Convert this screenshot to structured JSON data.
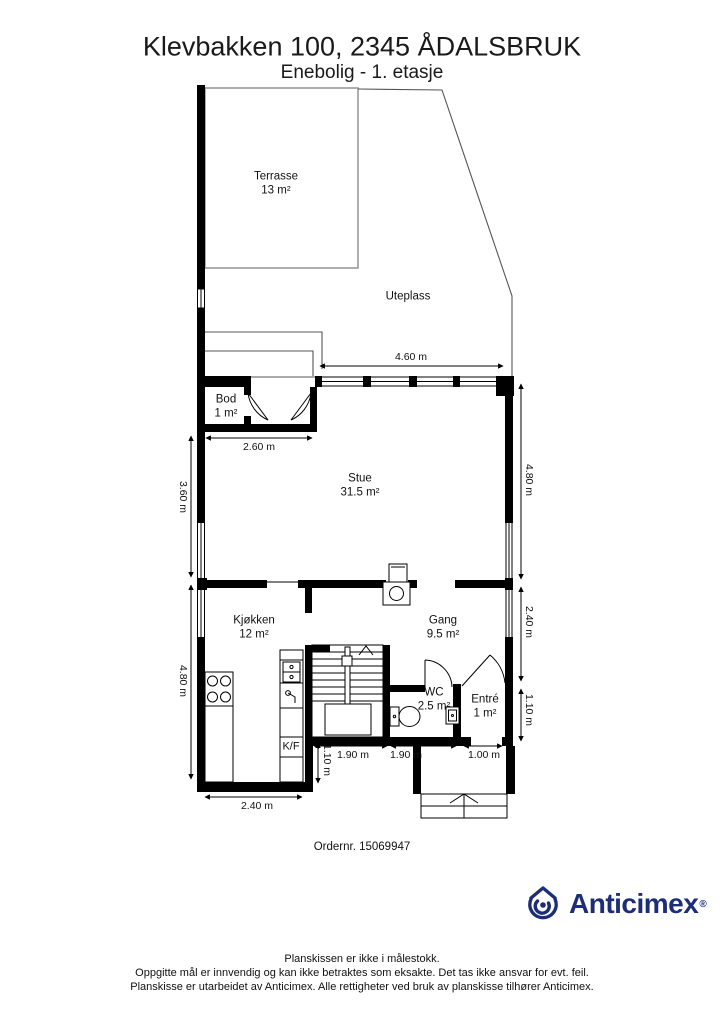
{
  "header": {
    "title": "Klevbakken 100, 2345 ÅDALSBRUK",
    "subtitle": "Enebolig - 1. etasje"
  },
  "plan": {
    "rooms": {
      "terrasse": {
        "name": "Terrasse",
        "area": "13 m²"
      },
      "uteplass": {
        "name": "Uteplass"
      },
      "bod": {
        "name": "Bod",
        "area": "1 m²"
      },
      "stue": {
        "name": "Stue",
        "area": "31.5 m²"
      },
      "kjokken": {
        "name": "Kjøkken",
        "area": "12 m²"
      },
      "gang": {
        "name": "Gang",
        "area": "9.5 m²"
      },
      "wc": {
        "name": "WC",
        "area": "2.5 m²"
      },
      "entre": {
        "name": "Entré",
        "area": "1 m²"
      }
    },
    "fixtures": {
      "fridge_freezer": "K/F"
    },
    "dimensions": {
      "stue_top_width": "4.60 m",
      "bod_width": "2.60 m",
      "stue_left_height": "3.60 m",
      "kjokken_left_height": "4.80 m",
      "stue_right_height": "4.80 m",
      "gang_right_height": "2.40 m",
      "entre_right_height": "1.10 m",
      "stairs_depth": "1.10 m",
      "stairs_width": "1.90 m",
      "wc_width": "1.90 m",
      "entre_width": "1.00 m",
      "kjokken_width": "2.40 m"
    },
    "order_number": "Ordernr. 15069947"
  },
  "branding": {
    "logo_text": "Anticimex",
    "registered_mark": "®",
    "brand_color": "#1e2d78"
  },
  "footer": {
    "line1": "Planskissen er ikke i målestokk.",
    "line2": "Oppgitte mål er innvendig og kan ikke betraktes som eksakte. Det tas ikke ansvar for evt. feil.",
    "line3": "Planskisse er utarbeidet av Anticimex. Alle rettigheter ved bruk av planskisse tilhører Anticimex."
  }
}
